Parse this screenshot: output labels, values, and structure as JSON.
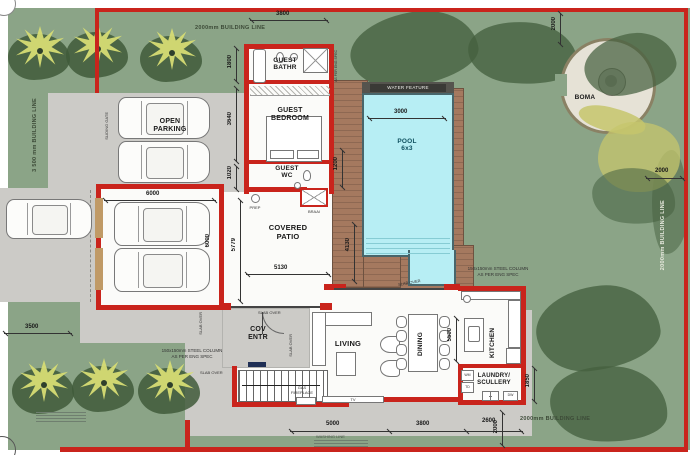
{
  "plan": {
    "building_lines": {
      "top": "2000mm BUILDING LINE",
      "left": "3 500 mm BUILDING LINE",
      "right": "2000mm BUILDING LINE",
      "bottom": "2000mm BUILDING LINE"
    },
    "rooms": {
      "open_parking": "OPEN\nPARKING",
      "double_garage": "DOUBLE\nGARAGE",
      "guest_bathroom": "GUEST\nBATHR",
      "guest_bedroom": "GUEST\nBEDROOM",
      "guest_wc": "GUEST\nWC",
      "covered_patio": "COVERED\nPATIO",
      "covered_entrance": "COV\nENTR",
      "living": "LIVING",
      "dining": "DINING",
      "kitchen": "KITCHEN",
      "laundry": "LAUNDRY/\nSCULLERY",
      "pool": "POOL\n6x3",
      "boma": "BOMA",
      "water_feature": "WATER FEATURE"
    },
    "dimensions": {
      "top_width": "3800",
      "boma_offset": "2000",
      "right_offset": "2000",
      "guest_bath_depth": "1800",
      "guest_bed_depth": "3640",
      "guest_wc_depth": "1020",
      "garage_width": "6000",
      "garage_depth": "6000",
      "patio_depth": "5779",
      "patio_width": "5130",
      "deck_upper": "1200",
      "deck_lower": "4130",
      "pool_width": "3000",
      "road_offset": "3500",
      "living_width": "5000",
      "dining_width": "3800",
      "kitchen_width": "2600",
      "bottom_offset": "2000",
      "dining_depth": "5500",
      "laundry_depth": "1850"
    },
    "annotations": {
      "washing_line": "WASHING LINE",
      "sliding_gate": "SLIDING GATE",
      "steel_column": "150x150mm STEEL COLUMN\nAS PER ENG SPEC",
      "steel_column_side": "AS PER ENG SPEC",
      "slab_over": "SLAB OVER",
      "prep": "PREP",
      "braai": "BRAAI",
      "gas_fireplace": "GAS\nFIREPLACE",
      "tv": "TV",
      "wm": "WM",
      "td": "TD",
      "dw": "DW"
    },
    "colors": {
      "wall_red": "#c9241c",
      "grass": "#8ba487",
      "pool": "#b7eef4",
      "deck": "#a5795f",
      "paving": "#cccbc7"
    }
  }
}
